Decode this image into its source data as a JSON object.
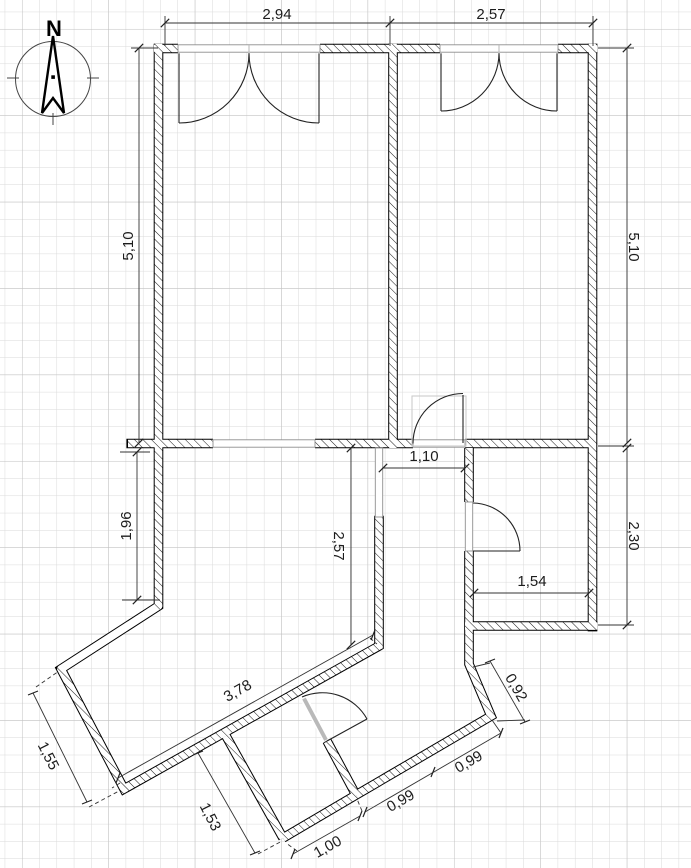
{
  "compass": {
    "label": "N"
  },
  "dimensions": {
    "top_left_width": "2,94",
    "top_right_width": "2,57",
    "left_upper_height": "5,10",
    "right_upper_height": "5,10",
    "left_lower_height": "1,96",
    "right_lower_height": "2,30",
    "hall_length": "2,57",
    "hall_width": "1,10",
    "bath_inner_width": "1,54",
    "diagonal_wall_length": "3,78",
    "southwest_wall_length": "1,55",
    "porch_wall_length": "1,53",
    "south_wall_length": "1,00",
    "southeast_wall_a": "0,99",
    "southeast_wall_b": "0,99",
    "east_return_length": "0,92"
  }
}
